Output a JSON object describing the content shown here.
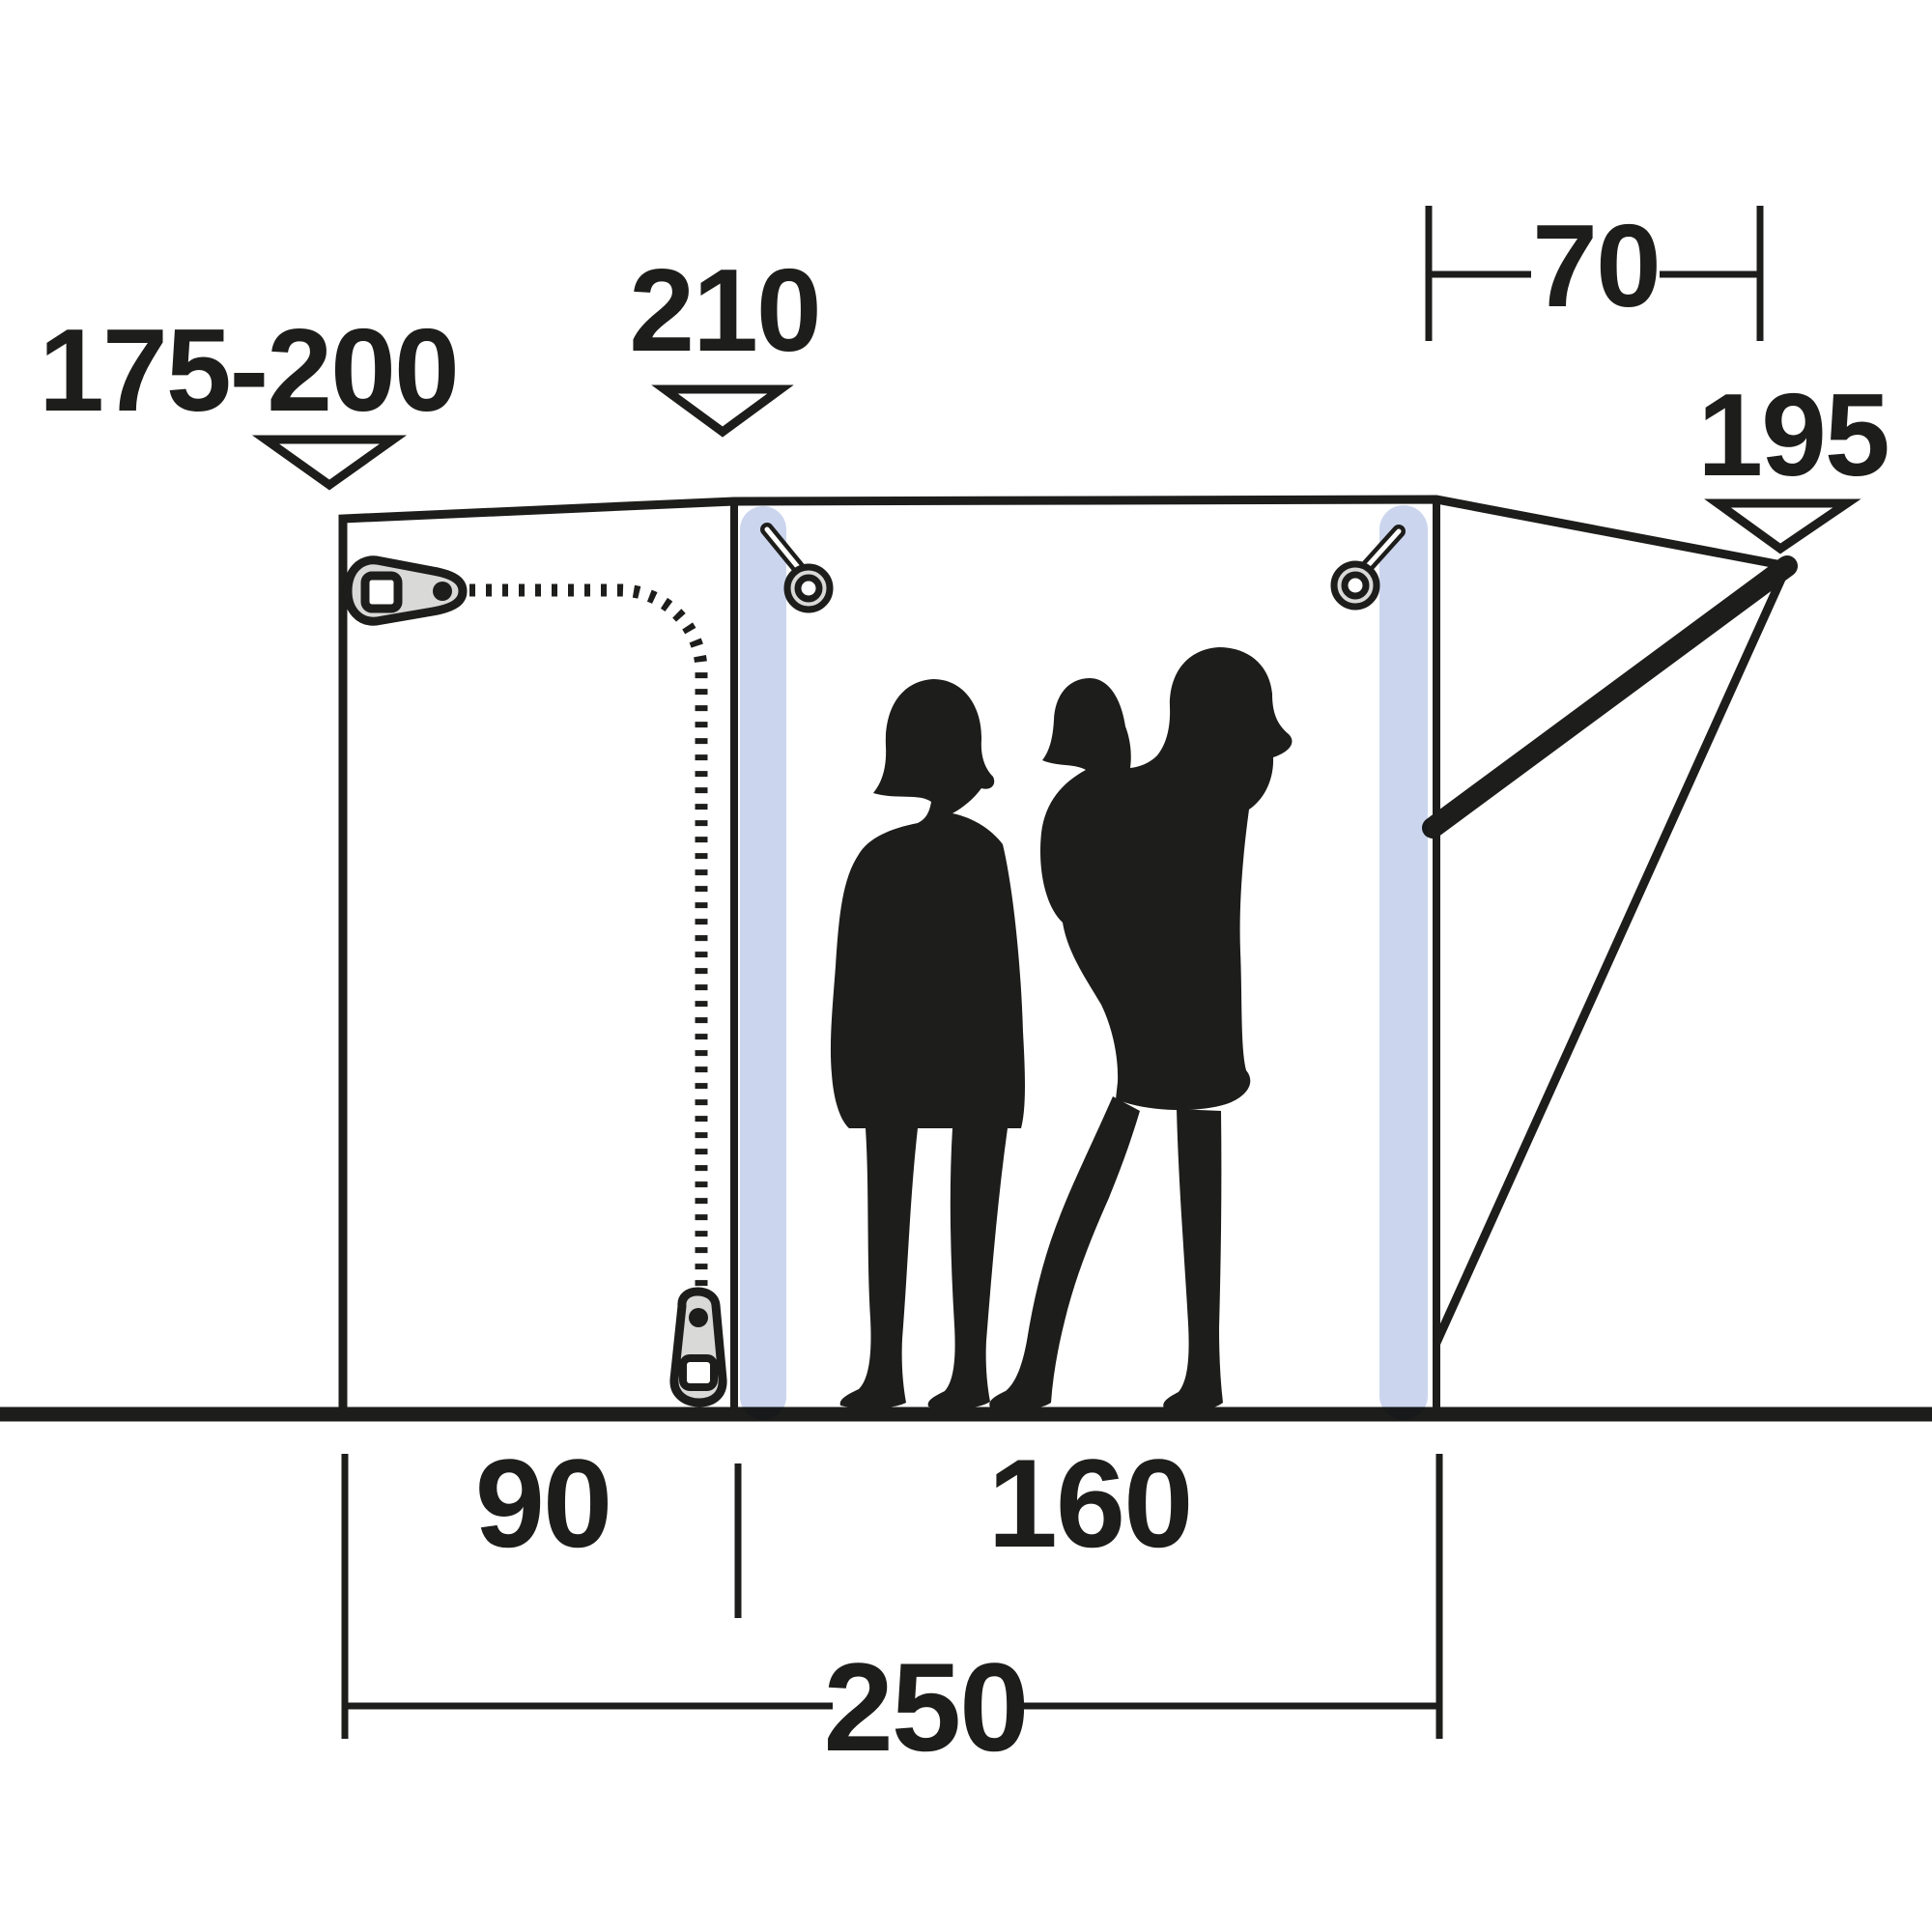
{
  "diagram": {
    "type": "awning-side-profile-dimension-drawing",
    "dimensions": {
      "connection_height": {
        "value": "175-200"
      },
      "peak_height": {
        "value": "210"
      },
      "canopy_depth": {
        "value": "70"
      },
      "rear_height": {
        "value": "195"
      },
      "front_width": {
        "value": "90"
      },
      "main_width": {
        "value": "160"
      },
      "total_width": {
        "value": "250"
      }
    },
    "icons": [
      "zipper-slider-icon",
      "zipper-pull-icon",
      "peg-ring-icon",
      "arrow-down-triangle-icon",
      "family-silhouette"
    ]
  },
  "colors": {
    "ink": "#1d1d1b",
    "pole": "#cbd5ee",
    "metal": "#d9d9d8",
    "background": "#ffffff"
  }
}
